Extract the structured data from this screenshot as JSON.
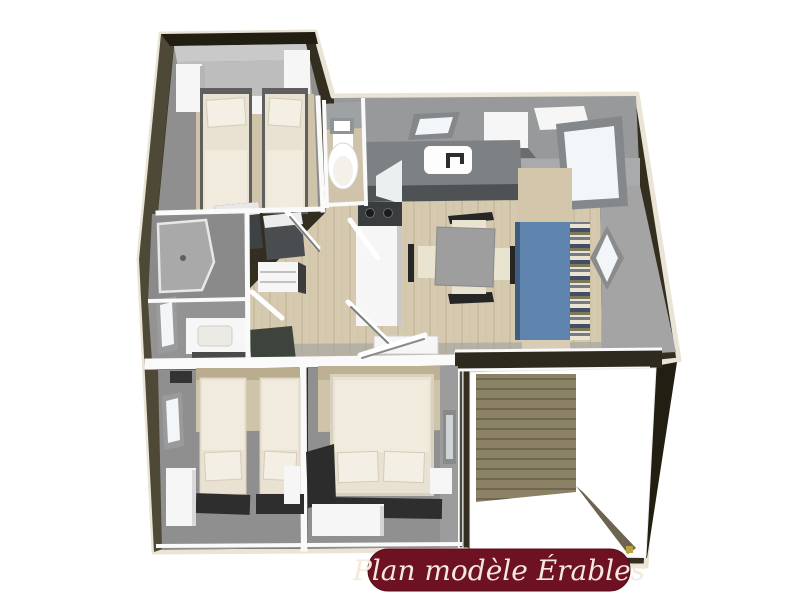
{
  "caption": {
    "label": "Plan modèle Érables"
  },
  "floorplan": {
    "kind": "3d-top-down-floorplan"
  },
  "colors": {
    "page-bg": "#ffffff",
    "trim-cream": "#e9e4d6",
    "wall-dark": "#342e20",
    "wall-darker": "#231e12",
    "wall-olive": "#4e4836",
    "wall-white": "#fafafa",
    "wall-gray": "#97999b",
    "wall-gray-light": "#c9c9c9",
    "wall-gray-mid": "#a8aaac",
    "floor-gray": "#8f8f8f",
    "floor-beige": "#cfc3a9",
    "floor-wood": "#d5c9af",
    "floor-wood-line": "#c7ba9e",
    "furn-white": "#f6f6f6",
    "mattress": "#e9e2d2",
    "sheet": "#f0ebdd",
    "pillow": "#f3efe5",
    "mat-dark": "#2e2e2e",
    "counter-gray": "#7d8184",
    "appliance-dark": "#3a3d3f",
    "sofa-blue": "#5e83ac",
    "stripe-navy": "#414e6b",
    "stripe-cream": "#e9e4d0",
    "stripe-olive": "#7b7857",
    "table-gray": "#9e9e9e",
    "chair-dark": "#262626",
    "deck-plank": "#8b8266",
    "deck-line": "#6c6450",
    "banner-bg": "#6e1122",
    "banner-text": "#f3ead9"
  }
}
